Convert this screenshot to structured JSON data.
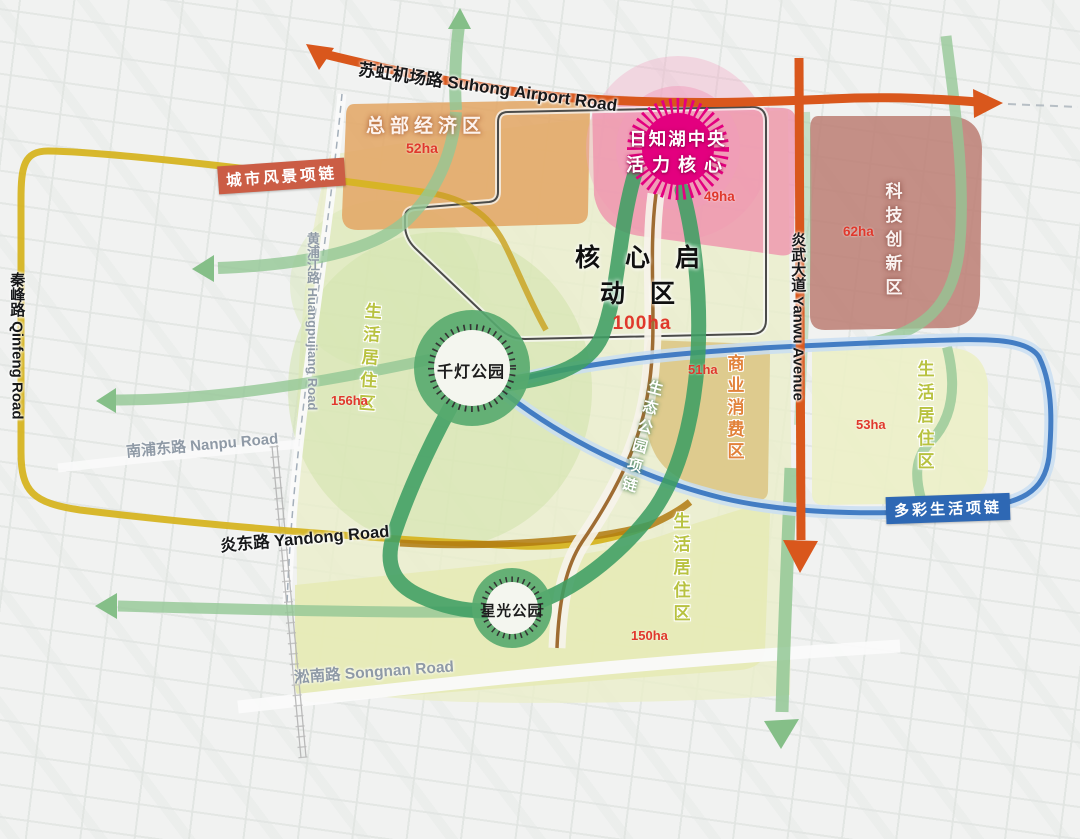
{
  "map": {
    "title_hint": "urban plan map of core startup area",
    "roads": {
      "suhong": "苏虹机场路 Suhong Airport Road",
      "qinfeng": "秦峰路 Qinfeng Road",
      "huangpujiang": "黄浦江路 Huangpujiang Road",
      "nanpu": "南浦东路 Nanpu Road",
      "yandong": "炎东路 Yandong Road",
      "songnan": "淞南路 Songnan Road",
      "yanwu": "炎武大道 Yanwu Avenue"
    },
    "necklaces": {
      "city": {
        "label": "城市风景项链",
        "bg": "#cb5d45"
      },
      "colorful": {
        "label": "多彩生活项链",
        "bg": "#2e68b4"
      },
      "eco": {
        "label": "生态公园项链"
      }
    },
    "core": {
      "label": "核 心 启 动 区",
      "area": "100ha"
    },
    "hub": {
      "line1": "日知湖中央",
      "line2": "活力核心",
      "area": "49ha"
    },
    "zones": {
      "hq": {
        "label": "总部经济区",
        "area": "52ha"
      },
      "tech": {
        "label": "科技创新区",
        "area": "62ha"
      },
      "commerce": {
        "label": "商业消费区",
        "area": "51ha"
      },
      "living_west": {
        "label": "生活居住区",
        "area": "156ha"
      },
      "living_east": {
        "label": "生活居住区",
        "area": "53ha"
      },
      "living_south": {
        "label": "生活居住区",
        "area": "150ha"
      }
    },
    "parks": {
      "qiandeng": "千灯公园",
      "xingguang": "星光公园"
    },
    "colors": {
      "orange_road": "#d9571c",
      "yellow_road": "#d6b422",
      "blue_necklace": "#3b77c1",
      "dark_green_loop": "#3f9e63",
      "light_green_band": "#93c795",
      "hub_magenta": "#e3007f",
      "area_text_red": "#e0382c",
      "hq_zone_fill": "#e2a766",
      "pink_zone_fill": "#ef93ad",
      "tech_zone_fill": "#bd8176",
      "commerce_zone_fill": "#dcc483",
      "living_zone_fill": "#e9ecc2"
    }
  }
}
